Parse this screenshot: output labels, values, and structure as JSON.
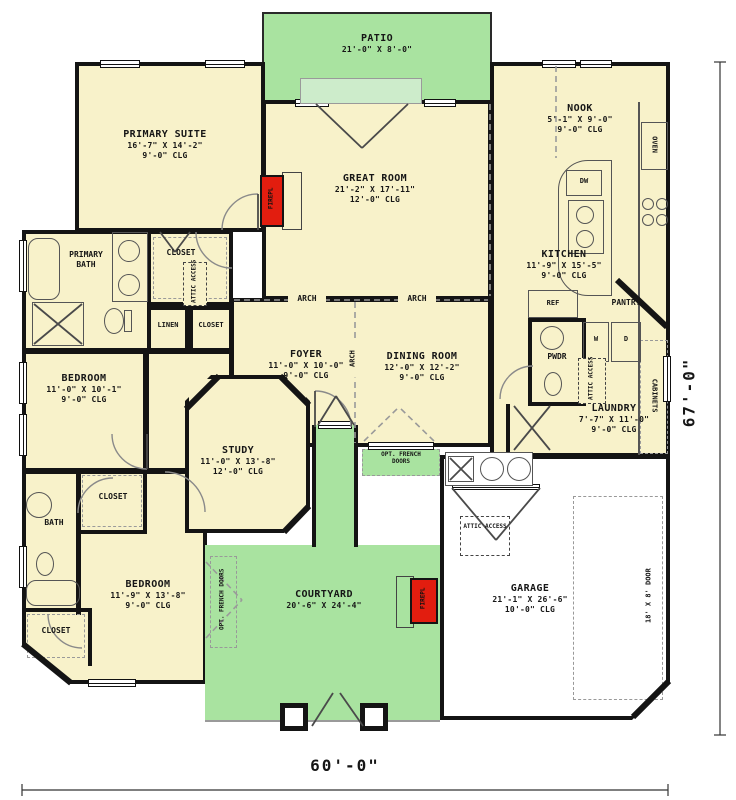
{
  "rooms": {
    "patio": {
      "name": "PATIO",
      "dims": "21'-0\" X 8'-0\""
    },
    "primary_suite": {
      "name": "PRIMARY SUITE",
      "dims": "16'-7\" X 14'-2\"",
      "clg": "9'-0\" CLG"
    },
    "great_room": {
      "name": "GREAT ROOM",
      "dims": "21'-2\" X 17'-11\"",
      "clg": "12'-0\" CLG"
    },
    "nook": {
      "name": "NOOK",
      "dims": "5'-1\" X 9'-0\"",
      "clg": "9'-0\" CLG"
    },
    "kitchen": {
      "name": "KITCHEN",
      "dims": "11'-9\" X 15'-5\"",
      "clg": "9'-0\" CLG"
    },
    "primary_bath": {
      "name": "PRIMARY BATH"
    },
    "foyer": {
      "name": "FOYER",
      "dims": "11'-0\" X 10'-0\"",
      "clg": "9'-0\" CLG"
    },
    "dining": {
      "name": "DINING ROOM",
      "dims": "12'-0\" X 12'-2\"",
      "clg": "9'-0\" CLG"
    },
    "bedroom1": {
      "name": "BEDROOM",
      "dims": "11'-0\" X 10'-1\"",
      "clg": "9'-0\" CLG"
    },
    "study": {
      "name": "STUDY",
      "dims": "11'-0\" X 13'-8\"",
      "clg": "12'-0\" CLG"
    },
    "laundry": {
      "name": "LAUNDRY",
      "dims": "7'-7\" X 11'-0\"",
      "clg": "9'-0\" CLG"
    },
    "bedroom2": {
      "name": "BEDROOM",
      "dims": "11'-9\" X 13'-8\"",
      "clg": "9'-0\" CLG"
    },
    "courtyard": {
      "name": "COURTYARD",
      "dims": "20'-6\" X 24'-4\""
    },
    "garage": {
      "name": "GARAGE",
      "dims": "21'-1\" X 26'-6\"",
      "clg": "10'-0\" CLG"
    }
  },
  "labels": {
    "arch": "ARCH",
    "linen": "LINEN",
    "closet": "CLOSET",
    "attic": "ATTIC ACCESS",
    "oven": "OVEN",
    "dw": "DW",
    "ref": "REF",
    "washer": "W",
    "dryer": "D",
    "pantry": "PANTRY",
    "cabinets": "CABINETS",
    "pwdr": "PWDR",
    "bath": "BATH",
    "fireplace": "FIREPL",
    "opt_french_line1": "OPT. FRENCH",
    "opt_french_line2": "DOORS",
    "opt_french": "OPT. FRENCH DOORS",
    "garage_door": "18' X 8' DOOR"
  },
  "dimensions": {
    "width": "60'-0\"",
    "height": "67'-0\""
  },
  "colors": {
    "floor": "#f8f2ca",
    "outdoor": "#a9e3a0",
    "wall": "#141414",
    "fireplace": "#e21d0f"
  }
}
